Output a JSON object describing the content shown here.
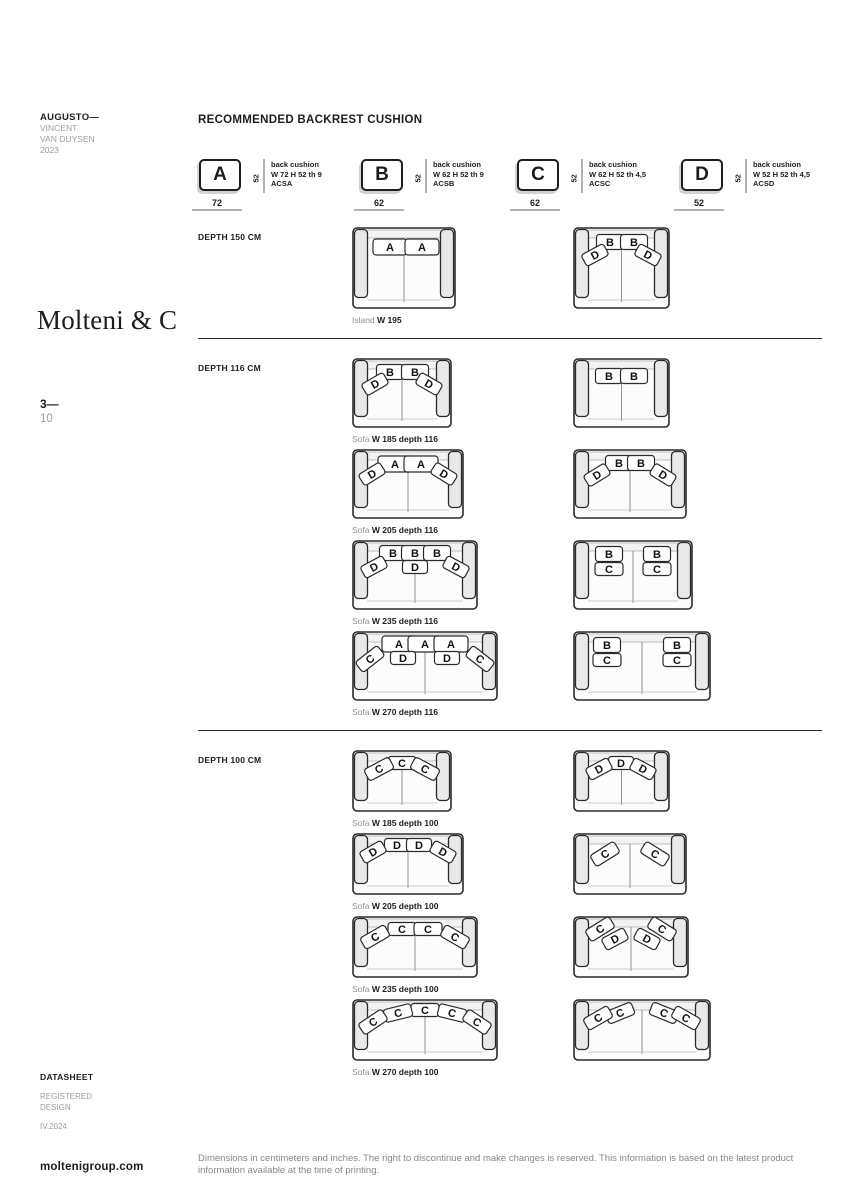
{
  "page": {
    "product": "AUGUSTO—",
    "designer": [
      "VINCENT",
      "VAN DUYSEN",
      "2023"
    ],
    "brand": "Molteni & C",
    "page_number": "3—",
    "page_total": "10",
    "doc_type": "DATASHEET",
    "registered": [
      "REGISTERED",
      "DESIGN"
    ],
    "edition": "IV.2024",
    "website": "moltenigroup.com",
    "footnote": "Dimensions in centimeters and inches. The right to discontinue and make changes is reserved. This information is based on the latest product information available at the time of printing."
  },
  "title": "RECOMMENDED BACKREST CUSHION",
  "colors": {
    "ink": "#1d1d1b",
    "gray_text": "#9d9d9c",
    "underline_gray": "#b2b2b2",
    "divider": "#2b2b2b"
  },
  "cushion_legend": [
    {
      "letter": "A",
      "height_label": "52",
      "desc_lines": [
        "back cushion",
        "W 72 H 52 th 9",
        "ACSA"
      ],
      "width_label": "72"
    },
    {
      "letter": "B",
      "height_label": "52",
      "desc_lines": [
        "back cushion",
        "W 62 H 52 th 9",
        "ACSB"
      ],
      "width_label": "62"
    },
    {
      "letter": "C",
      "height_label": "52",
      "desc_lines": [
        "back cushion",
        "W 62 H 52 th 4,5",
        "ACSC"
      ],
      "width_label": "62"
    },
    {
      "letter": "D",
      "height_label": "52",
      "desc_lines": [
        "back cushion",
        "W 52 H 52 th 4,5",
        "ACSD"
      ],
      "width_label": "52"
    }
  ],
  "sections": [
    {
      "label": "DEPTH 150 CM",
      "rows": [
        {
          "caption": {
            "prefix": "Island",
            "bold": "W 195"
          },
          "left": {
            "w": 104,
            "h": 82,
            "cushions": [
              [
                "A",
                38,
                20,
                0
              ],
              [
                "A",
                70,
                20,
                0
              ]
            ]
          },
          "right": {
            "w": 97,
            "h": 82,
            "cushions": [
              [
                "B",
                37,
                15,
                0
              ],
              [
                "B",
                61,
                15,
                0
              ],
              [
                "D",
                22,
                28,
                -28
              ],
              [
                "D",
                75,
                28,
                28
              ]
            ]
          }
        }
      ]
    },
    {
      "label": "DEPTH 116 CM",
      "rows": [
        {
          "caption": {
            "prefix": "Sofa",
            "bold": "W 185 depth 116"
          },
          "left": {
            "w": 100,
            "h": 70,
            "cushions": [
              [
                "B",
                38,
                14,
                0
              ],
              [
                "B",
                63,
                14,
                0
              ],
              [
                "D",
                23,
                26,
                -30
              ],
              [
                "D",
                77,
                26,
                30
              ]
            ]
          },
          "right": {
            "w": 97,
            "h": 70,
            "cushions": [
              [
                "B",
                36,
                18,
                0
              ],
              [
                "B",
                61,
                18,
                0
              ]
            ]
          }
        },
        {
          "caption": {
            "prefix": "Sofa",
            "bold": "W 205 depth 116"
          },
          "left": {
            "w": 112,
            "h": 70,
            "cushions": [
              [
                "A",
                43,
                15,
                0
              ],
              [
                "A",
                69,
                15,
                0
              ],
              [
                "D",
                20,
                25,
                -32
              ],
              [
                "D",
                92,
                25,
                32
              ]
            ]
          },
          "right": {
            "w": 114,
            "h": 70,
            "cushions": [
              [
                "B",
                46,
                14,
                0
              ],
              [
                "B",
                68,
                14,
                0
              ],
              [
                "D",
                24,
                26,
                -32
              ],
              [
                "D",
                90,
                26,
                32
              ]
            ]
          }
        },
        {
          "caption": {
            "prefix": "Sofa",
            "bold": "W 235 depth 116"
          },
          "left": {
            "w": 126,
            "h": 70,
            "cushions": [
              [
                "B",
                41,
                13,
                0
              ],
              [
                "B",
                63,
                13,
                0
              ],
              [
                "B",
                85,
                13,
                0
              ],
              [
                "D",
                22,
                27,
                -28
              ],
              [
                "D",
                63,
                27,
                0
              ],
              [
                "D",
                104,
                27,
                28
              ]
            ]
          },
          "right": {
            "w": 120,
            "h": 70,
            "cushions": [
              [
                "B",
                36,
                14,
                0
              ],
              [
                "C",
                36,
                29,
                0
              ],
              [
                "B",
                84,
                14,
                0
              ],
              [
                "C",
                84,
                29,
                0
              ]
            ]
          }
        },
        {
          "caption": {
            "prefix": "Sofa",
            "bold": "W 270 depth 116"
          },
          "left": {
            "w": 146,
            "h": 70,
            "cushions": [
              [
                "A",
                47,
                13,
                0
              ],
              [
                "A",
                73,
                13,
                0
              ],
              [
                "A",
                99,
                13,
                0
              ],
              [
                "C",
                18,
                28,
                -38
              ],
              [
                "D",
                51,
                27,
                0
              ],
              [
                "D",
                95,
                27,
                0
              ],
              [
                "C",
                128,
                28,
                38
              ]
            ]
          },
          "right": {
            "w": 138,
            "h": 70,
            "cushions": [
              [
                "B",
                34,
                14,
                0
              ],
              [
                "C",
                34,
                29,
                0
              ],
              [
                "B",
                104,
                14,
                0
              ],
              [
                "C",
                104,
                29,
                0
              ]
            ]
          }
        }
      ]
    },
    {
      "label": "DEPTH 100 CM",
      "rows": [
        {
          "caption": {
            "prefix": "Sofa",
            "bold": "W 185 depth 100"
          },
          "left": {
            "w": 100,
            "h": 62,
            "cushions": [
              [
                "C",
                50,
                13,
                0
              ],
              [
                "C",
                27,
                19,
                -28
              ],
              [
                "C",
                73,
                19,
                28
              ]
            ]
          },
          "right": {
            "w": 97,
            "h": 62,
            "cushions": [
              [
                "D",
                48,
                13,
                0
              ],
              [
                "D",
                26,
                19,
                -28
              ],
              [
                "D",
                70,
                19,
                28
              ]
            ]
          }
        },
        {
          "caption": {
            "prefix": "Sofa",
            "bold": "W 205 depth 100"
          },
          "left": {
            "w": 112,
            "h": 62,
            "cushions": [
              [
                "D",
                45,
                12,
                0
              ],
              [
                "D",
                67,
                12,
                0
              ],
              [
                "D",
                21,
                19,
                -30
              ],
              [
                "D",
                91,
                19,
                30
              ]
            ]
          },
          "right": {
            "w": 114,
            "h": 62,
            "cushions": [
              [
                "C",
                32,
                21,
                -32
              ],
              [
                "C",
                82,
                21,
                32
              ]
            ]
          }
        },
        {
          "caption": {
            "prefix": "Sofa",
            "bold": "W 235 depth 100"
          },
          "left": {
            "w": 126,
            "h": 62,
            "cushions": [
              [
                "C",
                50,
                13,
                0
              ],
              [
                "C",
                76,
                13,
                0
              ],
              [
                "C",
                23,
                21,
                -30
              ],
              [
                "C",
                103,
                21,
                30
              ]
            ]
          },
          "right": {
            "w": 116,
            "h": 62,
            "cushions": [
              [
                "C",
                27,
                13,
                -32
              ],
              [
                "D",
                42,
                23,
                -28
              ],
              [
                "C",
                89,
                13,
                32
              ],
              [
                "D",
                74,
                23,
                28
              ]
            ]
          }
        },
        {
          "caption": {
            "prefix": "Sofa",
            "bold": "W 270 depth 100"
          },
          "left": {
            "w": 146,
            "h": 62,
            "cushions": [
              [
                "C",
                73,
                11,
                0
              ],
              [
                "C",
                46,
                14,
                -14
              ],
              [
                "C",
                100,
                14,
                14
              ],
              [
                "C",
                21,
                23,
                -34
              ],
              [
                "C",
                125,
                23,
                34
              ]
            ]
          },
          "right": {
            "w": 138,
            "h": 62,
            "cushions": [
              [
                "C",
                47,
                14,
                -22
              ],
              [
                "C",
                25,
                19,
                -30
              ],
              [
                "C",
                91,
                14,
                22
              ],
              [
                "C",
                113,
                19,
                30
              ]
            ]
          }
        }
      ]
    }
  ]
}
